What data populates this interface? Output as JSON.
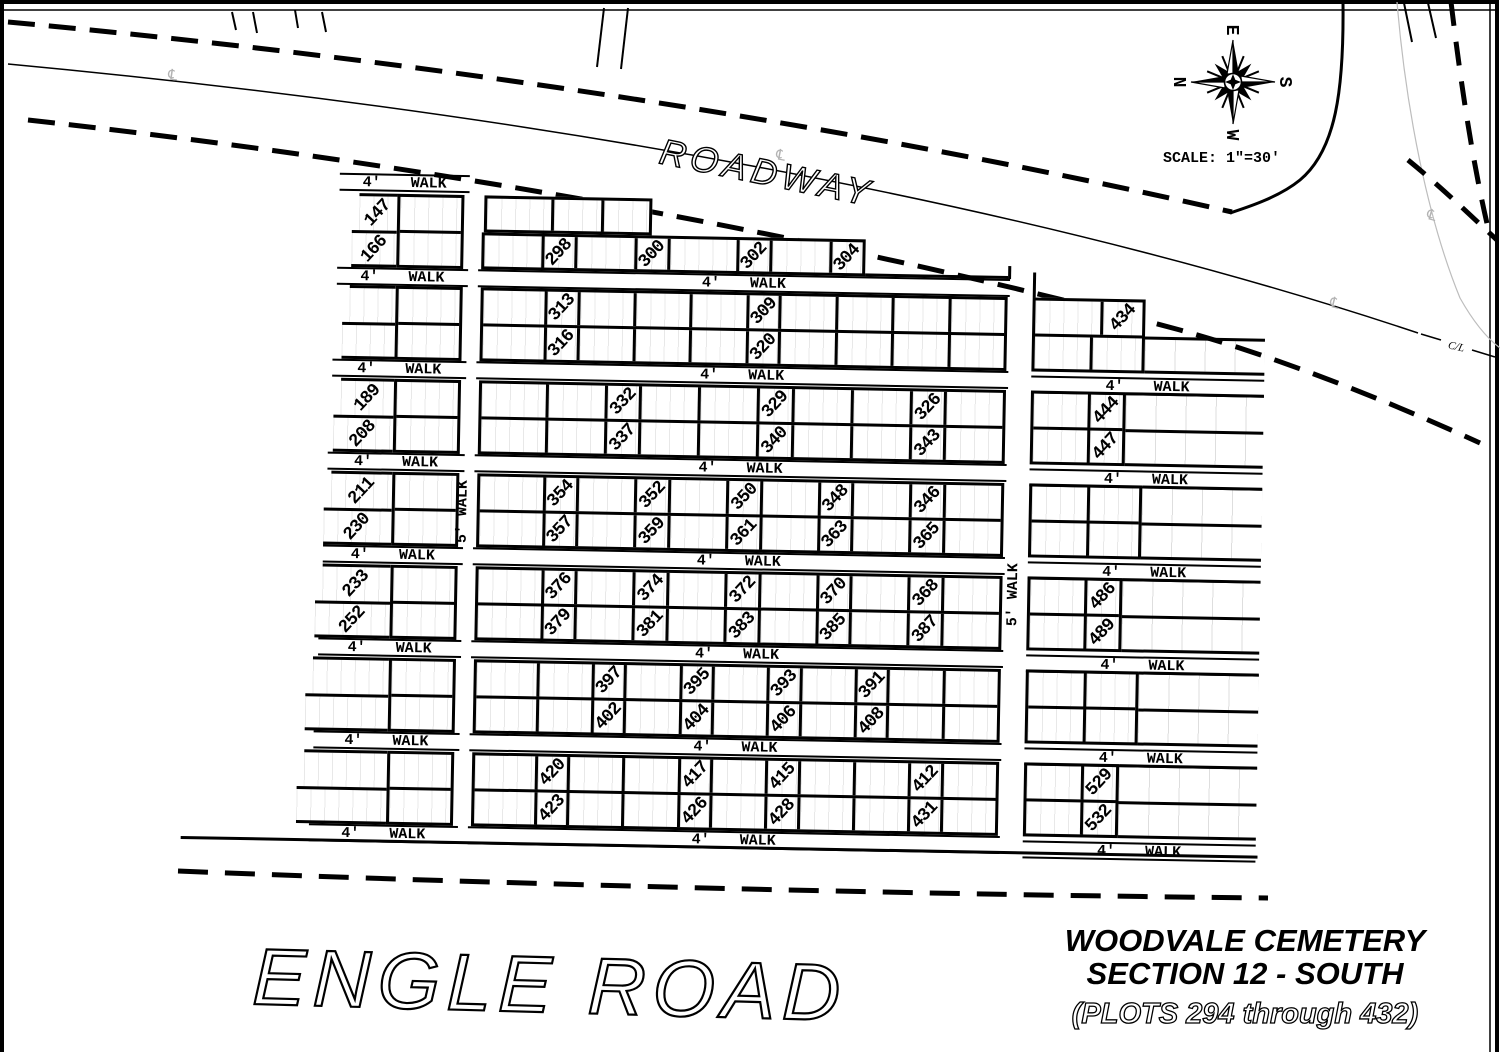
{
  "title": {
    "line1": "WOODVALE CEMETERY",
    "line2": "SECTION 12 - SOUTH",
    "line3": "(PLOTS 294 through 432)"
  },
  "labels": {
    "roadway": "ROADWAY",
    "engle_road": "ENGLE  ROAD",
    "scale": "SCALE: 1\"=30'",
    "cl": "C/L",
    "centerline_symbol": "℄"
  },
  "compass": {
    "top": "E",
    "right": "S",
    "bottom": "W",
    "left": "N"
  },
  "walk": {
    "size": "4'",
    "word": "WALK",
    "vertical": "5' WALK"
  },
  "left_sections": [
    {
      "rows": [
        [
          {
            "n": "147",
            "rot": true
          },
          "146"
        ],
        [
          {
            "n": "166",
            "rot": true
          },
          "167"
        ]
      ]
    },
    {
      "rows": [
        [
          "169",
          "168"
        ],
        [
          "186",
          "187"
        ]
      ]
    },
    {
      "rows": [
        [
          {
            "n": "189",
            "rot": true
          },
          "188"
        ],
        [
          {
            "n": "208",
            "rot": true
          },
          "209"
        ]
      ]
    },
    {
      "rows": [
        [
          {
            "n": "211",
            "rot": true
          },
          "210"
        ],
        [
          {
            "n": "230",
            "rot": true
          },
          "231"
        ]
      ]
    },
    {
      "rows": [
        [
          {
            "n": "233",
            "rot": true
          },
          "232"
        ],
        [
          {
            "n": "252",
            "rot": true
          },
          "253"
        ]
      ]
    },
    {
      "rows": [
        [
          "255",
          "254"
        ],
        [
          "272",
          "273"
        ]
      ]
    },
    {
      "rows": [
        [
          "275",
          "274"
        ],
        [
          "292",
          "293"
        ]
      ]
    }
  ],
  "middle_sections": [
    {
      "rows": [
        [
          "294",
          "295",
          "296"
        ],
        [
          "297",
          {
            "n": "298",
            "rot": true
          },
          "299",
          {
            "n": "300",
            "rot": true
          },
          "301",
          {
            "n": "302",
            "rot": true
          },
          "303",
          {
            "n": "304",
            "rot": true
          }
        ]
      ]
    },
    {
      "rows": [
        [
          "314",
          {
            "n": "313",
            "rot": true
          },
          "312",
          "311",
          "310",
          {
            "n": "309",
            "rot": true
          },
          "308",
          "307",
          "306",
          "305"
        ],
        [
          "315",
          {
            "n": "316",
            "rot": true
          },
          "317",
          "318",
          "319",
          {
            "n": "320",
            "rot": true
          },
          "321",
          "322",
          "323",
          "324"
        ]
      ]
    },
    {
      "rows": [
        [
          "334",
          "333",
          {
            "n": "332",
            "rot": true
          },
          "331",
          "330",
          {
            "n": "329",
            "rot": true
          },
          "328",
          "327",
          {
            "n": "326",
            "rot": true
          },
          "325"
        ],
        [
          "335",
          "336",
          {
            "n": "337",
            "rot": true
          },
          "338",
          "339",
          {
            "n": "340",
            "rot": true
          },
          "341",
          "342",
          {
            "n": "343",
            "rot": true
          },
          "344"
        ]
      ]
    },
    {
      "rows": [
        [
          "355",
          {
            "n": "354",
            "rot": true
          },
          "353",
          {
            "n": "352",
            "rot": true
          },
          "351",
          {
            "n": "350",
            "rot": true
          },
          "349",
          {
            "n": "348",
            "rot": true
          },
          "347",
          {
            "n": "346",
            "rot": true
          },
          "345"
        ],
        [
          "356",
          {
            "n": "357",
            "rot": true
          },
          "358",
          {
            "n": "359",
            "rot": true
          },
          "360",
          {
            "n": "361",
            "rot": true
          },
          "362",
          {
            "n": "363",
            "rot": true
          },
          "364",
          {
            "n": "365",
            "rot": true
          },
          "366"
        ]
      ]
    },
    {
      "rows": [
        [
          "377",
          {
            "n": "376",
            "rot": true
          },
          "375",
          {
            "n": "374",
            "rot": true
          },
          "373",
          {
            "n": "372",
            "rot": true
          },
          "371",
          {
            "n": "370",
            "rot": true
          },
          "369",
          {
            "n": "368",
            "rot": true
          },
          "367"
        ],
        [
          "378",
          {
            "n": "379",
            "rot": true
          },
          "380",
          {
            "n": "381",
            "rot": true
          },
          "382",
          {
            "n": "383",
            "rot": true
          },
          "384",
          {
            "n": "385",
            "rot": true
          },
          "386",
          {
            "n": "387",
            "rot": true
          },
          "388"
        ]
      ]
    },
    {
      "rows": [
        [
          "399",
          "398",
          {
            "n": "397",
            "rot": true
          },
          "396",
          {
            "n": "395",
            "rot": true
          },
          "394",
          {
            "n": "393",
            "rot": true
          },
          "392",
          {
            "n": "391",
            "rot": true
          },
          "390",
          "389"
        ],
        [
          "400",
          "401",
          {
            "n": "402",
            "rot": true
          },
          "403",
          {
            "n": "404",
            "rot": true
          },
          "405",
          {
            "n": "406",
            "rot": true
          },
          "407",
          {
            "n": "408",
            "rot": true
          },
          "409",
          "410"
        ]
      ]
    },
    {
      "rows": [
        [
          "421",
          {
            "n": "420",
            "rot": true
          },
          "419",
          "418",
          {
            "n": "417",
            "rot": true
          },
          "416",
          {
            "n": "415",
            "rot": true
          },
          "414",
          "413",
          {
            "n": "412",
            "rot": true
          },
          "411"
        ],
        [
          "422",
          {
            "n": "423",
            "rot": true
          },
          "424",
          "425",
          {
            "n": "426",
            "rot": true
          },
          "427",
          {
            "n": "428",
            "rot": true
          },
          "429",
          "430",
          {
            "n": "431",
            "rot": true
          },
          "432"
        ]
      ]
    }
  ],
  "right_sections": [
    {
      "rows": [
        [
          "433",
          {
            "n": "434",
            "rot": true
          }
        ],
        [
          "435",
          "436"
        ]
      ]
    },
    {
      "rows": [
        [
          "445",
          {
            "n": "444",
            "rot": true
          }
        ],
        [
          "446",
          {
            "n": "447",
            "rot": true
          }
        ]
      ]
    },
    {
      "rows": [
        [
          "464",
          "463"
        ],
        [
          "465",
          "466"
        ]
      ]
    },
    {
      "rows": [
        [
          "487",
          {
            "n": "486",
            "rot": true
          }
        ],
        [
          "488",
          {
            "n": "489",
            "rot": true
          }
        ]
      ]
    },
    {
      "rows": [
        [
          "510",
          "509"
        ],
        [
          "511",
          "512"
        ]
      ]
    },
    {
      "rows": [
        [
          "530",
          {
            "n": "529",
            "rot": true
          }
        ],
        [
          "531",
          {
            "n": "532",
            "rot": true
          }
        ]
      ]
    }
  ]
}
